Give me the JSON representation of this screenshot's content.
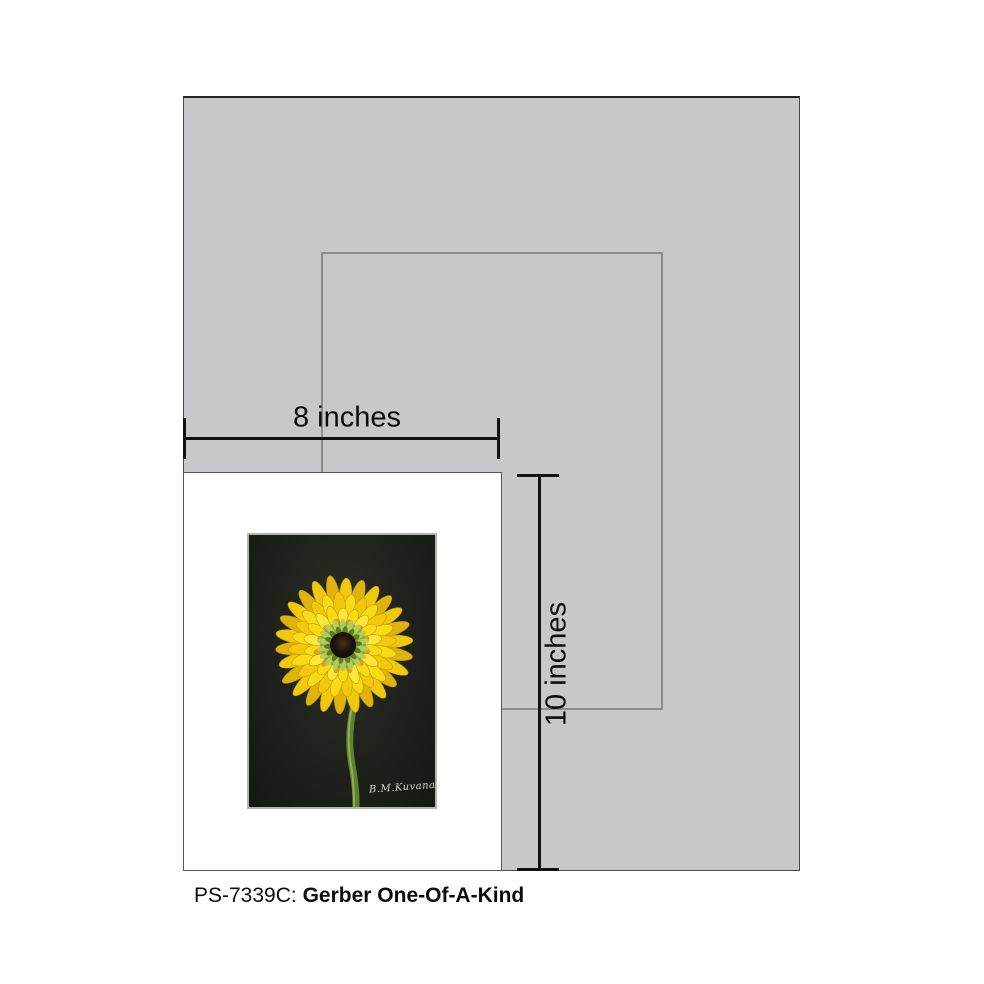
{
  "caption": {
    "sku": "PS-7339C:",
    "title": "Gerber One-Of-A-Kind"
  },
  "dimension_labels": {
    "width": "8 inches",
    "height": "10 inches"
  },
  "artwork": {
    "signature": "B.M.Kuvanas",
    "description": "yellow gerbera daisy painting on black background"
  },
  "colors": {
    "mat_gray": "#c8c8ca",
    "opening_outline": "#8d8d8d",
    "dimension_line": "#111111",
    "art_background": "#1d201b",
    "petal_outer": "#f0c90d",
    "petal_dark": "#dfb30c",
    "petal_mid": "#f9da16",
    "petal_light": "#ffe63a",
    "petal_edge": "#b98f08",
    "accent_orange": "#e59a22",
    "green_mid": "#86a832",
    "green_light": "#b5cc5d",
    "green_dark": "#5d7c22",
    "center_dark": "#17100a",
    "stem": "#5f8230",
    "stem_light": "#93b050"
  }
}
